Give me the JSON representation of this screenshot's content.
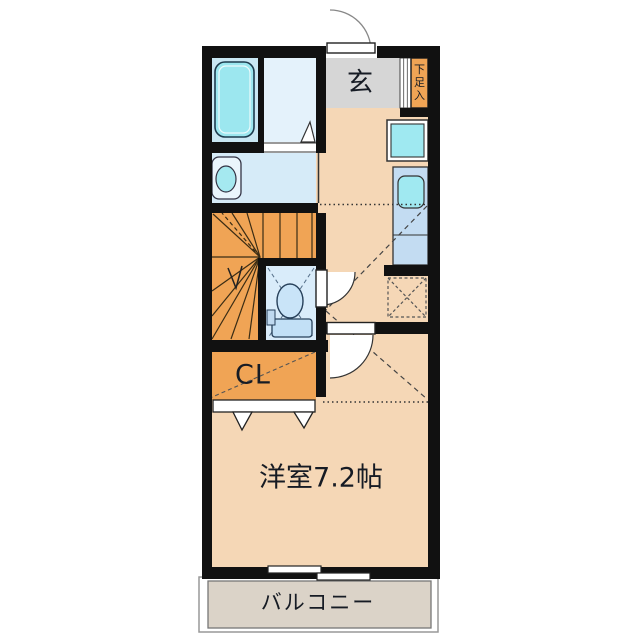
{
  "labels": {
    "entrance": "玄",
    "shoe_storage": "下足入",
    "closet": "CL",
    "western_room": "洋室7.2帖",
    "balcony": "バルコニー"
  },
  "colors": {
    "wall": "#111111",
    "floor_peach": "#F5D7B6",
    "stairs_orange": "#F0A455",
    "entrance_gray": "#D6D6D6",
    "bathroom_blue": "#C9E7F3",
    "washroom_blue": "#D6EBF8",
    "toilet_blue": "#D9ECFA",
    "kitchen_blue": "#C3DCF2",
    "fixture_cyan": "#9FE9F1",
    "balcony_beige": "#DBD3C8"
  },
  "fixtures": [
    "bathtub",
    "washbasin",
    "toilet",
    "kitchen-sink",
    "washing-machine-pan",
    "refrigerator-space",
    "staircase",
    "shoe-cabinet",
    "entrance-door",
    "toilet-door",
    "room-door",
    "closet-folding-doors",
    "sliding-window"
  ]
}
